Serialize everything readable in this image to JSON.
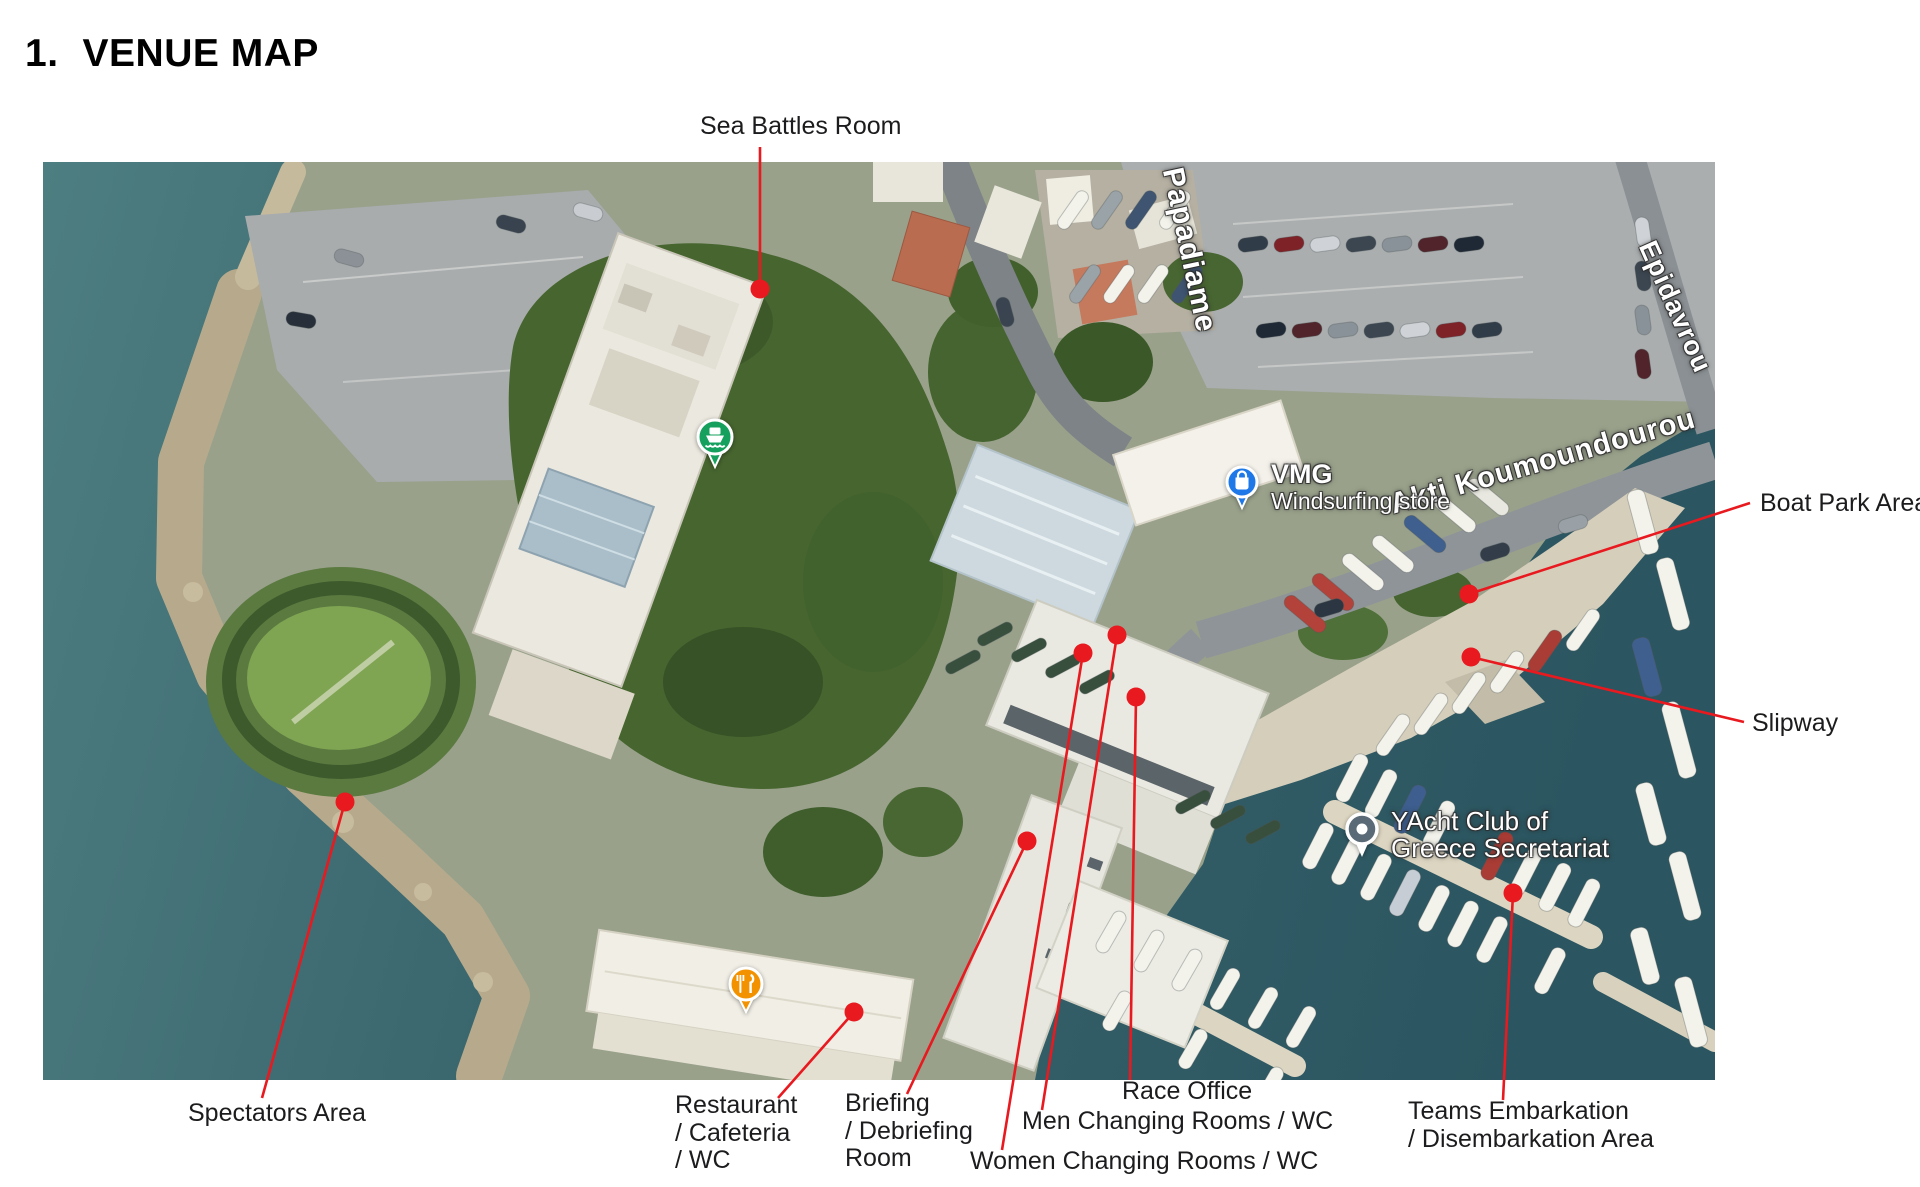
{
  "page": {
    "heading_number": "1.",
    "heading_text": "VENUE MAP"
  },
  "map": {
    "accent_color": "#e8191f",
    "street_labels": [
      {
        "name": "papadiamanti-street",
        "text": "Papadiame",
        "x": 1146,
        "y": 88,
        "rotate": 78,
        "size": 30
      },
      {
        "name": "epidavrou-street",
        "text": "Epidavrou",
        "x": 1632,
        "y": 145,
        "rotate": 66,
        "size": 27
      },
      {
        "name": "akti-koumoundourou-street",
        "text": "Akti Koumoundourou",
        "x": 1500,
        "y": 300,
        "rotate": -16,
        "size": 29
      }
    ],
    "pois": [
      {
        "name": "vmg-windsurfing-store",
        "icon": "shopping-bag-pin",
        "pin_color": "#1f78e8",
        "x": 1202,
        "y": 321,
        "lines": [
          "VMG",
          "Windsurfing store"
        ],
        "line_sizes": [
          27,
          23
        ],
        "line_weights": [
          700,
          500
        ],
        "text_side": "right"
      },
      {
        "name": "yacht-club-secretariat",
        "icon": "place-pin",
        "pin_color": "#5a6a77",
        "x": 1322,
        "y": 668,
        "lines": [
          "YAcht Club of",
          "Greece Secretariat"
        ],
        "line_sizes": [
          26,
          26
        ],
        "line_weights": [
          500,
          500
        ],
        "text_side": "right"
      },
      {
        "name": "enteuktirio-restaurant",
        "icon": "restaurant-pin",
        "pin_color": "#f39200",
        "x": 704,
        "y": 821,
        "lines": [
          "Enteuktirio",
          "Εντευκτήριο"
        ],
        "line_sizes": [
          28,
          24
        ],
        "line_weights": [
          600,
          500
        ],
        "text_side": "left"
      },
      {
        "name": "ferry-place",
        "icon": "ferry-pin",
        "pin_color": "#16a05d",
        "x": 672,
        "y": 273,
        "lines": [],
        "line_sizes": [],
        "line_weights": [],
        "text_side": "right"
      }
    ],
    "callouts": [
      {
        "name": "sea-battles-room",
        "lines": [
          "Sea Battles Room"
        ],
        "label_x": 700,
        "label_y": 113,
        "anchor": [
          760,
          147
        ],
        "dot": [
          760,
          289
        ]
      },
      {
        "name": "boat-park-area",
        "lines": [
          "Boat Park Area"
        ],
        "label_x": 1760,
        "label_y": 490,
        "anchor": [
          1750,
          503
        ],
        "dot": [
          1469,
          594
        ]
      },
      {
        "name": "slipway",
        "lines": [
          "Slipway"
        ],
        "label_x": 1752,
        "label_y": 710,
        "anchor": [
          1744,
          722
        ],
        "dot": [
          1471,
          657
        ]
      },
      {
        "name": "spectators-area",
        "lines": [
          "Spectators Area"
        ],
        "label_x": 188,
        "label_y": 1100,
        "anchor": [
          262,
          1098
        ],
        "dot": [
          345,
          802
        ]
      },
      {
        "name": "restaurant-cafeteria-wc",
        "lines": [
          "Restaurant",
          "/ Cafeteria",
          "/ WC"
        ],
        "label_x": 675,
        "label_y": 1092,
        "anchor": [
          778,
          1098
        ],
        "dot": [
          854,
          1012
        ]
      },
      {
        "name": "briefing-debriefing-room",
        "lines": [
          "Briefing",
          "/ Debriefing",
          "Room"
        ],
        "label_x": 845,
        "label_y": 1090,
        "anchor": [
          907,
          1094
        ],
        "dot": [
          1027,
          841
        ]
      },
      {
        "name": "women-changing-rooms-wc",
        "lines": [
          "Women Changing Rooms / WC"
        ],
        "label_x": 970,
        "label_y": 1148,
        "anchor": [
          1002,
          1150
        ],
        "dot": [
          1083,
          653
        ]
      },
      {
        "name": "men-changing-rooms-wc",
        "lines": [
          "Men Changing Rooms / WC"
        ],
        "label_x": 1022,
        "label_y": 1108,
        "anchor": [
          1042,
          1110
        ],
        "dot": [
          1117,
          635
        ]
      },
      {
        "name": "race-office",
        "lines": [
          "Race Office"
        ],
        "label_x": 1122,
        "label_y": 1078,
        "anchor": [
          1130,
          1080
        ],
        "dot": [
          1136,
          697
        ]
      },
      {
        "name": "teams-embarkation-disembarkation",
        "lines": [
          "Teams Embarkation",
          "/ Disembarkation Area"
        ],
        "label_x": 1408,
        "label_y": 1098,
        "anchor": [
          1503,
          1100
        ],
        "dot": [
          1513,
          893
        ]
      }
    ]
  }
}
